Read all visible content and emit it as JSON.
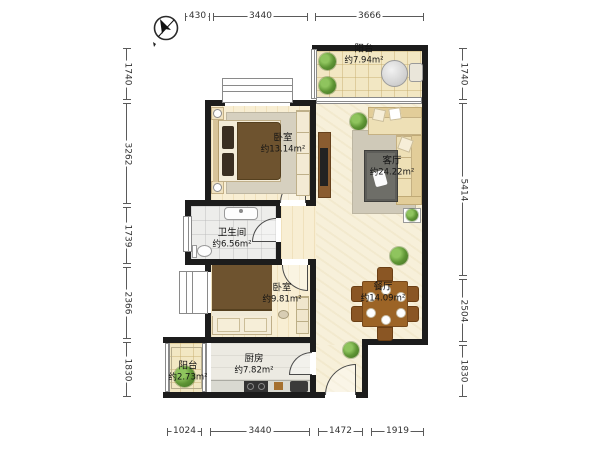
{
  "rooms": {
    "balcony_top": {
      "name": "阳台",
      "area": "约7.94m²"
    },
    "bedroom_main": {
      "name": "卧室",
      "area": "约13.14m²"
    },
    "living": {
      "name": "客厅",
      "area": "约24.22m²"
    },
    "bathroom": {
      "name": "卫生间",
      "area": "约6.56m²"
    },
    "bedroom_second": {
      "name": "卧室",
      "area": "约9.81m²"
    },
    "dining": {
      "name": "餐厅",
      "area": "约14.09m²"
    },
    "kitchen": {
      "name": "厨房",
      "area": "约7.82m²"
    },
    "balcony_bottom": {
      "name": "阳台",
      "area": "约2.73m²"
    }
  },
  "dimensions": {
    "top": [
      "430",
      "3440",
      "3666"
    ],
    "bottom": [
      "1024",
      "3440",
      "1472",
      "1919"
    ],
    "left": [
      "1740",
      "3262",
      "1739",
      "2366",
      "1830"
    ],
    "right": [
      "1740",
      "5414",
      "2504",
      "1830"
    ]
  },
  "icons": {
    "compass": "north-compass"
  },
  "colors": {
    "wall": "#1c1c1c",
    "floor_warm": "#f8eed3",
    "floor_cream": "#f7f0da",
    "floor_tile": "#f2e7c3",
    "floor_gray": "#ededeb",
    "wood": "#9c6426",
    "blanket": "#6e532f",
    "dim_text": "#333333"
  }
}
